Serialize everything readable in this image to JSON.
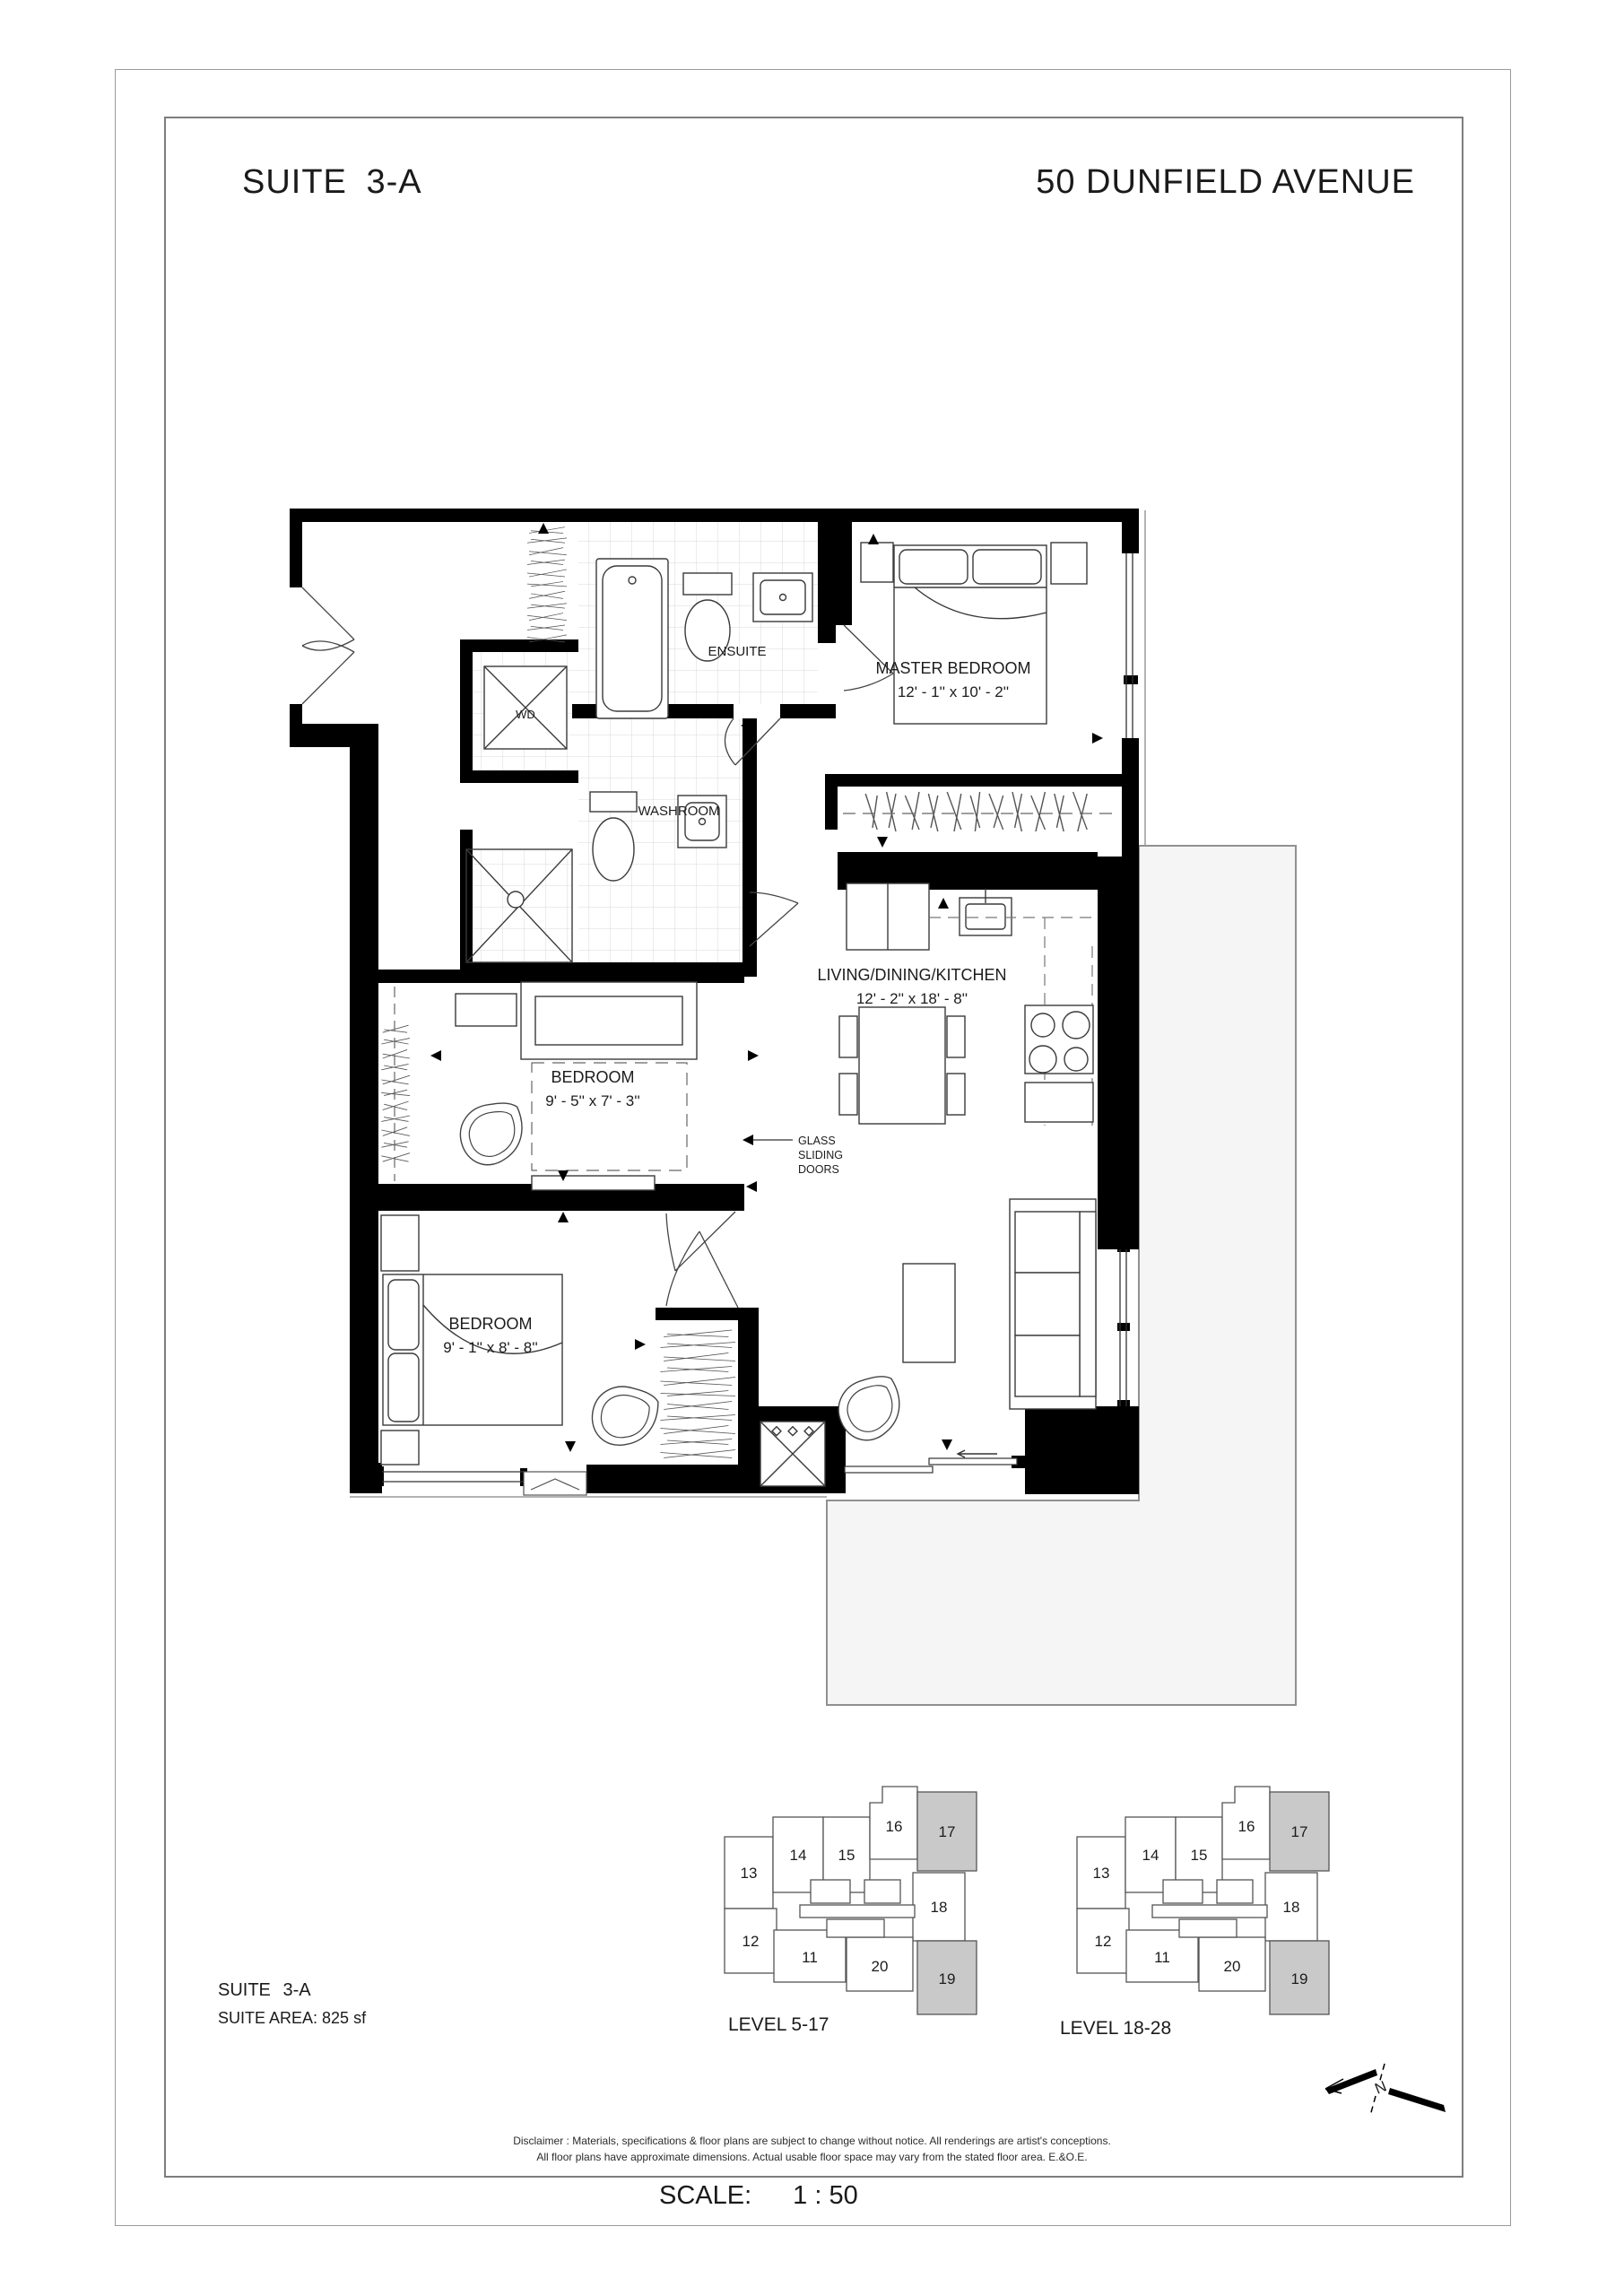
{
  "header": {
    "suite": "SUITE  3-A",
    "address": "50 DUNFIELD AVENUE"
  },
  "plan": {
    "ensuite": "ENSUITE",
    "washroom": "WASHROOM",
    "wd": "WD",
    "master_name": "MASTER BEDROOM",
    "master_dims": "12' - 1''  x  10' - 2''",
    "bedroom_mid_name": "BEDROOM",
    "bedroom_mid_dims": "9' - 5''  x  7' - 3''",
    "bedroom_low_name": "BEDROOM",
    "bedroom_low_dims": "9' - 1''  x  8' - 8''",
    "living_name": "LIVING/DINING/KITCHEN",
    "living_dims": "12' - 2''  x  18' - 8''",
    "glass_1": "GLASS",
    "glass_2": "SLIDING",
    "glass_3": "DOORS"
  },
  "suite_info": {
    "suite": "SUITE  3-A",
    "area": "SUITE AREA: 825 sf"
  },
  "keyplans": {
    "left_label": "LEVEL 5-17",
    "right_label": "LEVEL 18-28"
  },
  "units": {
    "u11": "11",
    "u12": "12",
    "u13": "13",
    "u14": "14",
    "u15": "15",
    "u16": "16",
    "u17": "17",
    "u18": "18",
    "u19": "19",
    "u20": "20"
  },
  "footer": {
    "disclaimer_1": "Disclaimer : Materials, specifications & floor plans are subject to change without notice. All renderings are artist's conceptions.",
    "disclaimer_2": "All floor plans have approximate dimensions. Actual usable floor space may vary from the stated floor area. E.&O.E.",
    "scale_label": "SCALE:",
    "scale_value": "1 : 50"
  },
  "north": {
    "label": "N"
  },
  "colors": {
    "wall": "#000000",
    "unit_highlight": "#c9c9c9",
    "terrace_fill": "#f5f5f5",
    "border_gray": "#7d7d7d"
  }
}
